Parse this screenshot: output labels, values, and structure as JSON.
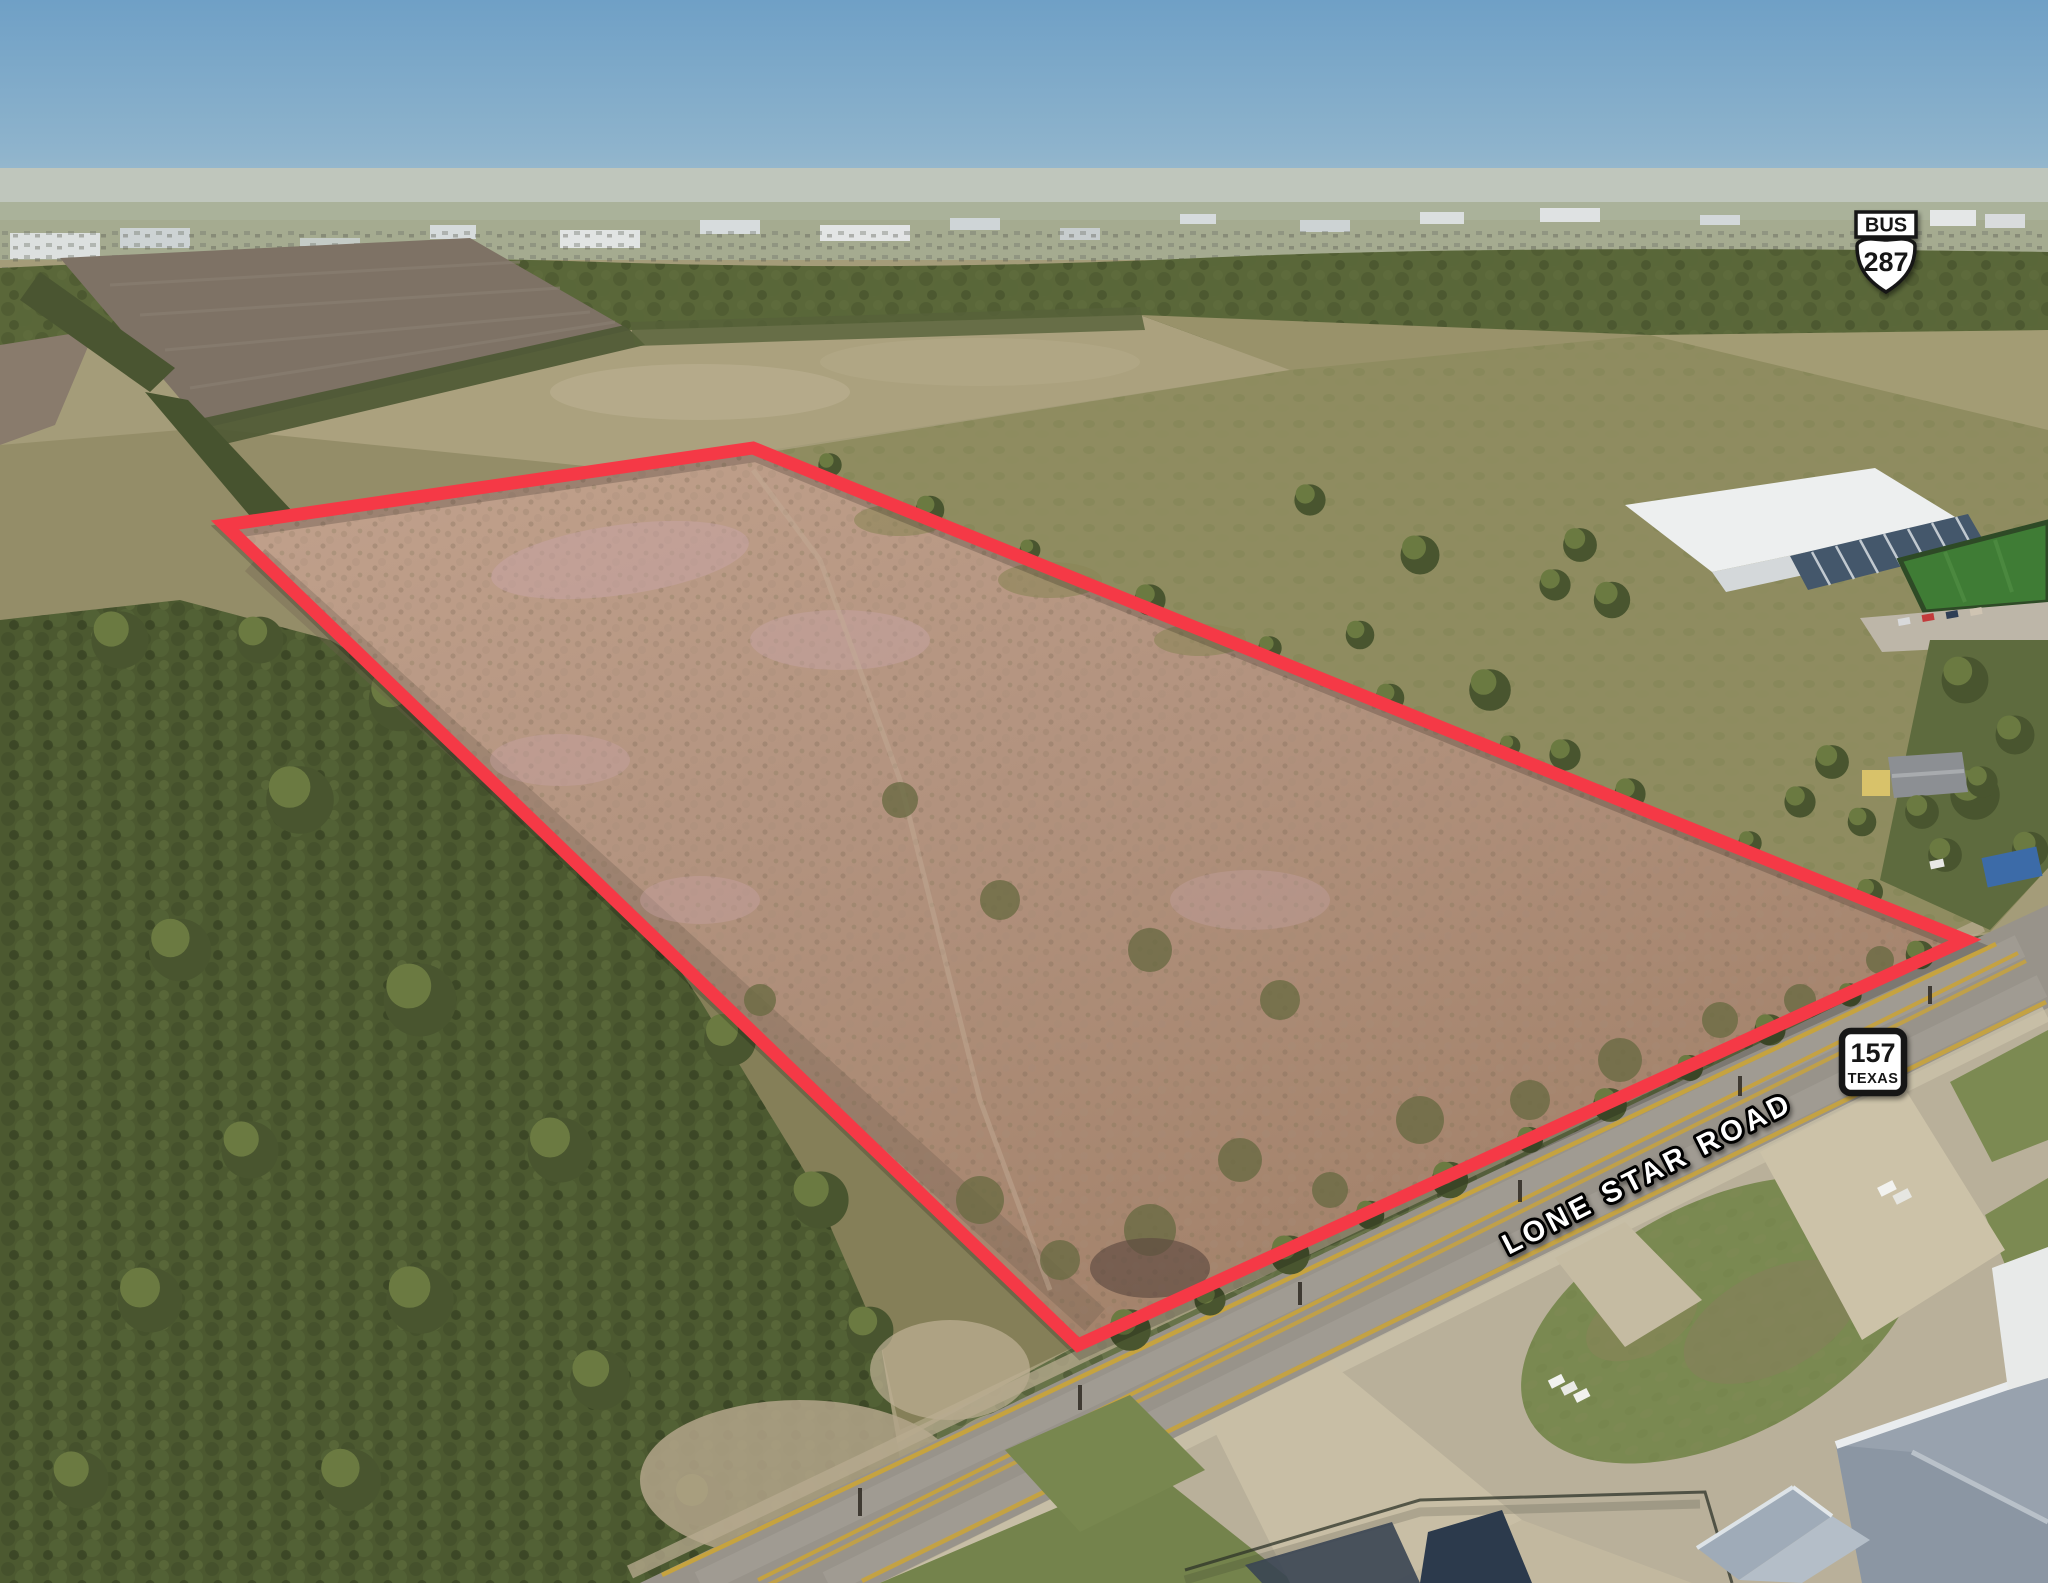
{
  "labels": {
    "road": "LONE STAR ROAD"
  },
  "shields": {
    "bus287": {
      "banner": "BUS",
      "route": "287"
    },
    "tx157": {
      "route": "157",
      "state": "TEXAS"
    }
  },
  "colors": {
    "boundary": "#F53946",
    "label_fill": "#FFFFFF",
    "label_stroke": "#000000",
    "shield_bg": "#FFFFFF",
    "shield_border": "#141414"
  }
}
